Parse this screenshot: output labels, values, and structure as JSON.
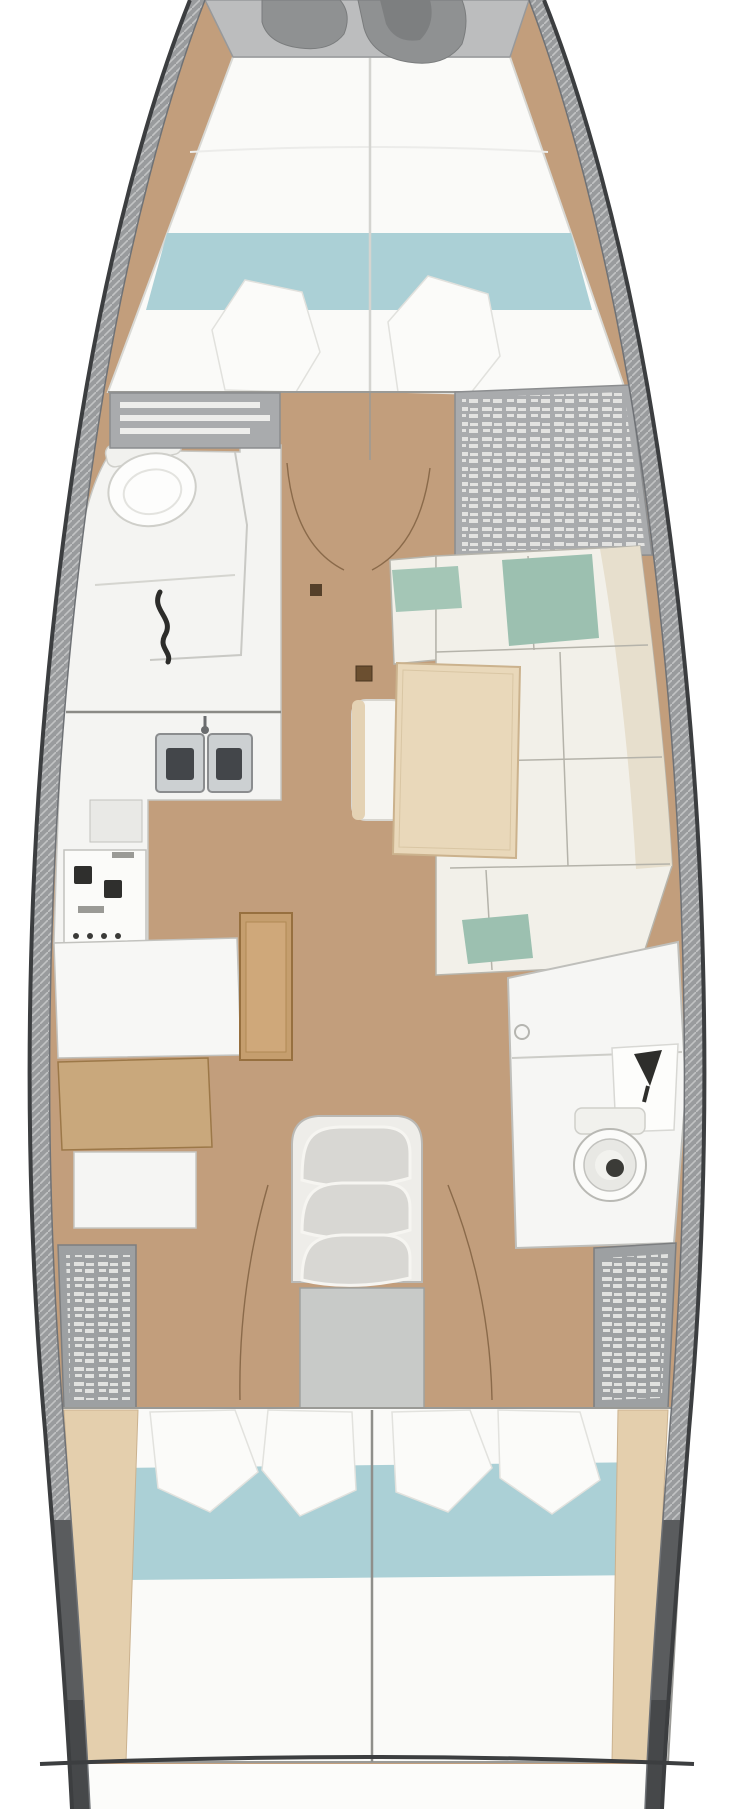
{
  "diagram": {
    "kind": "yacht-interior-floor-plan",
    "view": "top-down-bow-up",
    "rooms": [
      {
        "id": "bow-anchor-locker",
        "name": "anchor-locker"
      },
      {
        "id": "forward-cabin",
        "name": "v-berth-cabin",
        "features": [
          "double-bed",
          "teal-blanket",
          "two-pillows",
          "side-shelves"
        ]
      },
      {
        "id": "forward-head",
        "name": "forward-bathroom",
        "features": [
          "toilet",
          "shower-hook",
          "counter"
        ]
      },
      {
        "id": "galley",
        "name": "galley",
        "features": [
          "double-sink",
          "stove",
          "counters"
        ]
      },
      {
        "id": "salon",
        "name": "salon",
        "features": [
          "l-shaped-settee",
          "teal-cushions",
          "dining-table",
          "tucked-seat"
        ]
      },
      {
        "id": "nav-station",
        "name": "chart-table",
        "features": [
          "desk",
          "wood-top",
          "seat-front"
        ]
      },
      {
        "id": "companionway",
        "name": "companionway-stairs",
        "steps": 3
      },
      {
        "id": "aft-head",
        "name": "aft-bathroom",
        "features": [
          "round-toilet",
          "vanity-sink",
          "dark-faucet"
        ]
      },
      {
        "id": "aft-cabin",
        "name": "aft-double-cabins",
        "features": [
          "two-beds",
          "teal-blankets",
          "four-pillows",
          "center-divider"
        ]
      },
      {
        "id": "stern",
        "name": "transom"
      }
    ],
    "colors": {
      "background": "#ffffff",
      "hull_outline": "#3c3e40",
      "hull_band": "#999b9d",
      "hull_band_dark": "#5a5c5e",
      "hull_band_darkest": "#46484a",
      "floor_wood": "#c29e7c",
      "deck_gray": "#bcbdbe",
      "anchor_gear": "#8f9192",
      "furniture_white": "#f4f4f2",
      "mattress_white": "#fafaf8",
      "blanket_teal": "#abd0d6",
      "cushion_teal": "#9cc0b0",
      "backrest_cream": "#e7dfcd",
      "table_wood": "#e9d8ba",
      "chart_table_wood": "#c9a87c",
      "pillar_wood": "#c59e6e",
      "locker_gray": "#9da0a2",
      "shelf_gray": "#a9abad",
      "stairs_tread": "#d8d7d3",
      "stairs_landing": "#c8cac8",
      "fixture_dark": "#2e2e2b"
    }
  }
}
